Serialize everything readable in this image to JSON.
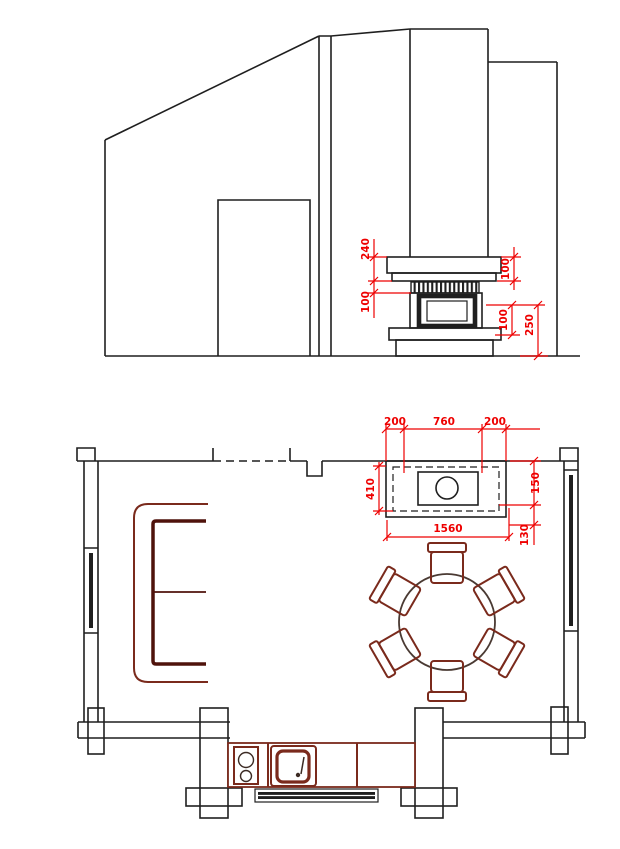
{
  "drawing": {
    "type": "architectural-cad-drawing",
    "views": [
      "fireplace-elevation",
      "floor-plan"
    ]
  },
  "colors": {
    "line": "#1f1f1f",
    "dimension_red": "#ee0000",
    "furniture_maroon": "#7a2a1c",
    "furniture_dark": "#4f120b"
  },
  "elevation": {
    "dim_labels": {
      "left_upper": "240",
      "left_lower": "100",
      "right_upper": "100",
      "right_lower_inner": "100",
      "right_lower_outer": "250"
    }
  },
  "plan": {
    "dim_labels": {
      "top_left": "200",
      "top_center": "760",
      "top_right": "200",
      "left_depth": "410",
      "right_upper": "150",
      "right_lower": "130",
      "bottom_total": "1560"
    }
  }
}
